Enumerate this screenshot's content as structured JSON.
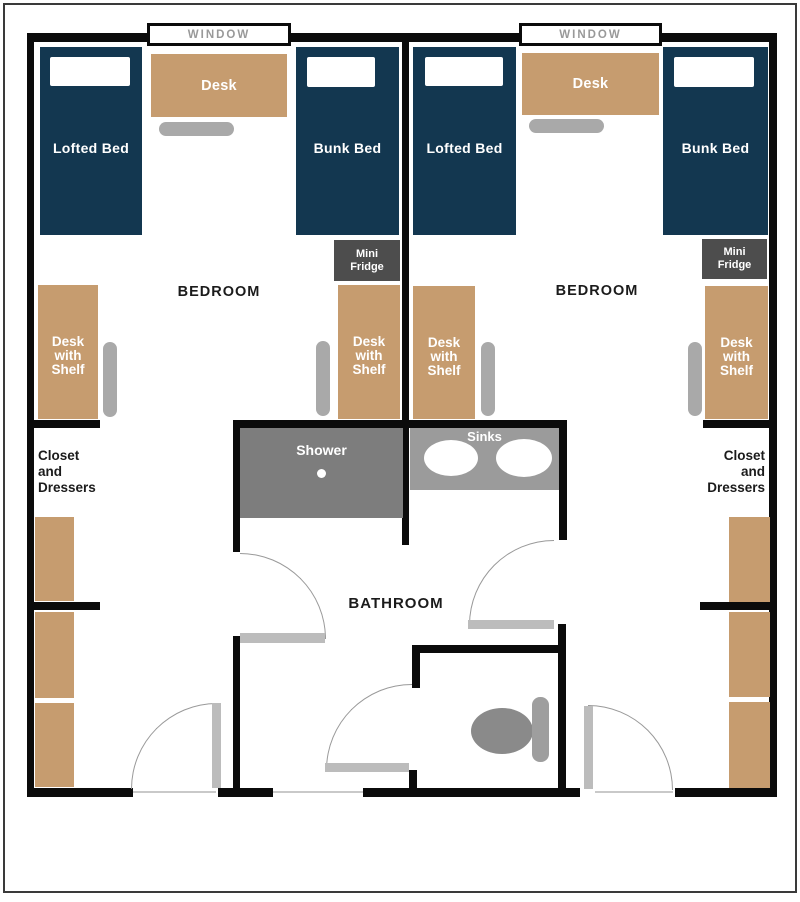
{
  "colors": {
    "wall": "#0b0b0b",
    "frame": "#3a3a3a",
    "navy": "#133750",
    "tan": "#C69C6F",
    "chair": "#A9A9A9",
    "fridge": "#4d4d4d",
    "shower": "#7d7d7d",
    "counter": "#9b9b9b",
    "bowl": "#8a8a8a",
    "tank": "#9e9e9e",
    "door": "#bcbcbc",
    "winlabel": "#999999"
  },
  "labels": {
    "window": "WINDOW",
    "bedroom": "BEDROOM",
    "bathroom": "BATHROOM",
    "lofted_bed": "Lofted Bed",
    "bunk_bed": "Bunk Bed",
    "desk": "Desk",
    "desk_shelf_1": "Desk",
    "desk_shelf_2": "with",
    "desk_shelf_3": "Shelf",
    "fridge_1": "Mini",
    "fridge_2": "Fridge",
    "closet_1": "Closet",
    "closet_2": "and",
    "closet_3": "Dressers",
    "shower": "Shower",
    "sinks": "Sinks"
  }
}
